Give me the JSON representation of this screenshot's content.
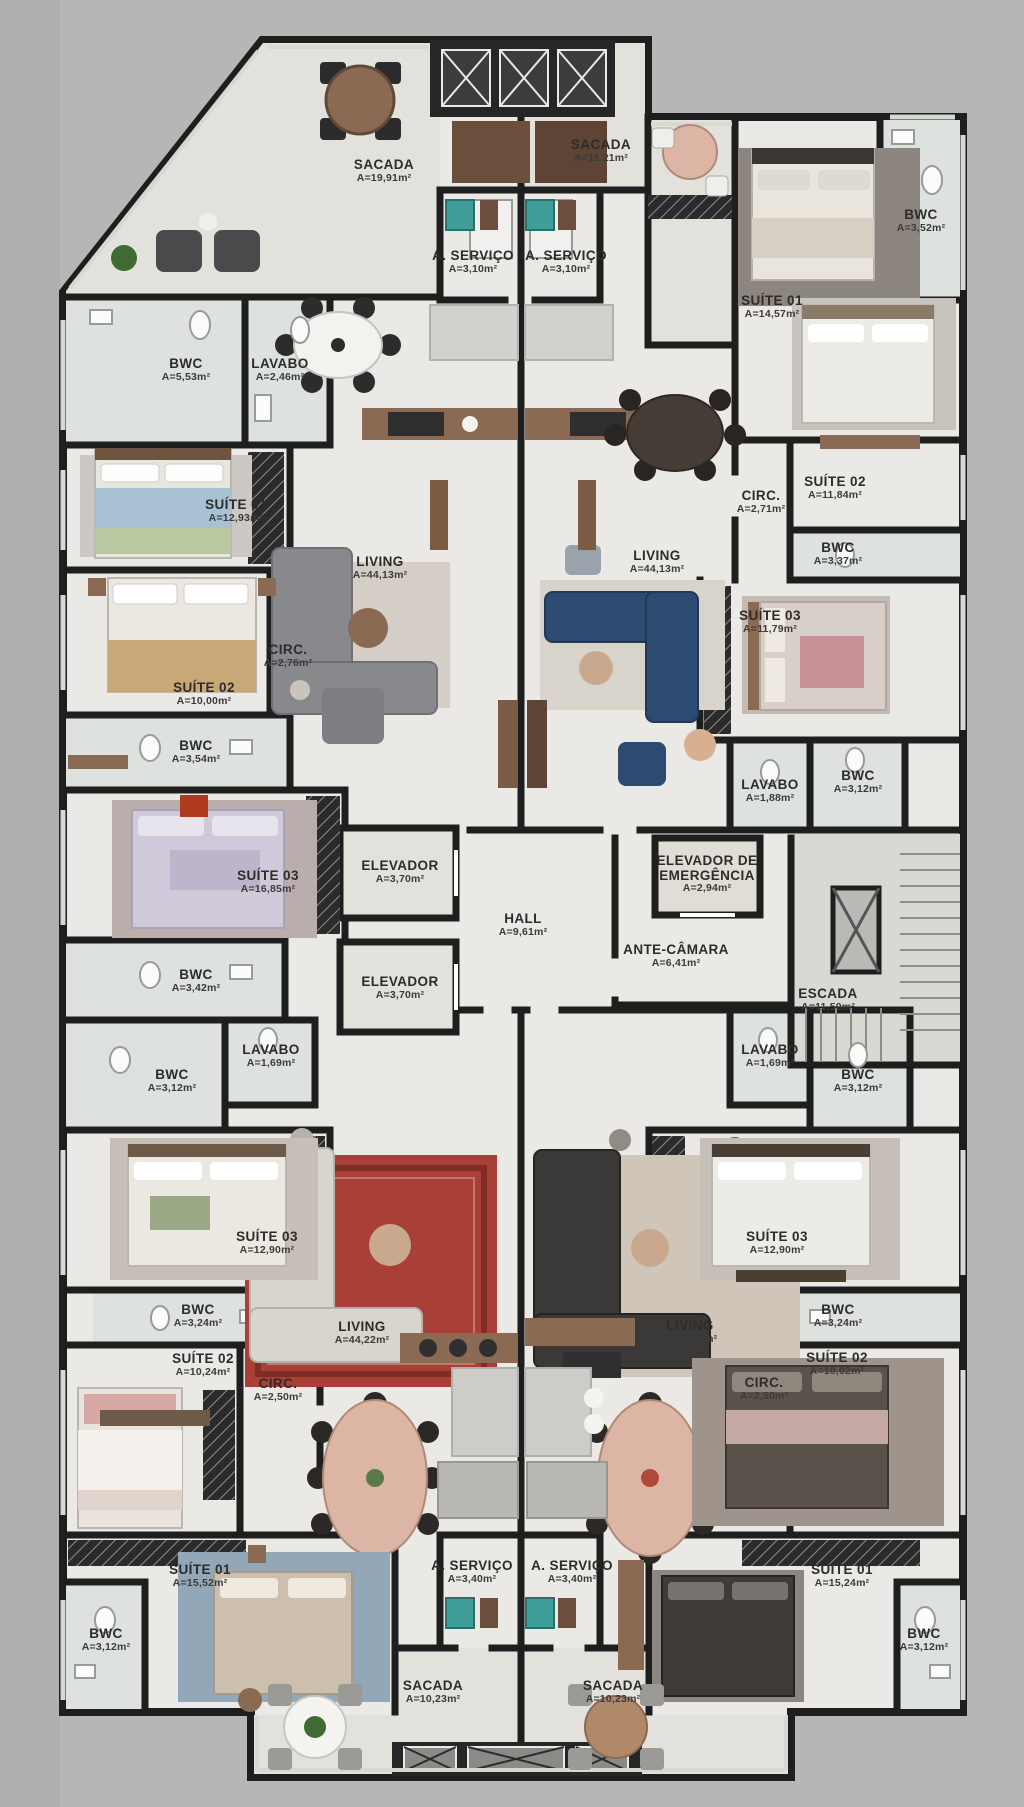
{
  "palette": {
    "exterior": "#b5b7b4",
    "floor": "#eae9e5",
    "balcony_floor": "#e2e1dc",
    "bath_floor": "#dde2df",
    "core_floor": "#d9d8d3",
    "wall": "#1e1e1e",
    "window": "#d6d8d3",
    "wood": "#8a6a52",
    "sofa_blue": "#2d4b70",
    "rug_red": "#a84038",
    "closet": "#2b2b2b"
  },
  "rooms": [
    {
      "id": "sacada-upper-left",
      "name": "SACADA",
      "area": "A=19,91m²",
      "x": 384,
      "y": 171
    },
    {
      "id": "sacada-upper-center",
      "name": "SACADA",
      "area": "A=11,21m²",
      "x": 601,
      "y": 151
    },
    {
      "id": "aservico-upper-left",
      "name": "A. SERVIÇO",
      "area": "A=3,10m²",
      "x": 473,
      "y": 262
    },
    {
      "id": "aservico-upper-right",
      "name": "A. SERVIÇO",
      "area": "A=3,10m²",
      "x": 566,
      "y": 262
    },
    {
      "id": "suite01-upper-right",
      "name": "SUÍTE 01",
      "area": "A=14,57m²",
      "x": 772,
      "y": 307
    },
    {
      "id": "bwc-upper-right",
      "name": "BWC",
      "area": "A=3,52m²",
      "x": 921,
      "y": 221
    },
    {
      "id": "bwc-upper-left",
      "name": "BWC",
      "area": "A=5,53m²",
      "x": 186,
      "y": 370
    },
    {
      "id": "lavabo-upper-left",
      "name": "LAVABO",
      "area": "A=2,46m²",
      "x": 280,
      "y": 370
    },
    {
      "id": "suite01-upper-left",
      "name": "SUÍTE 01",
      "area": "A=12,93m²",
      "x": 236,
      "y": 511
    },
    {
      "id": "suite02-upper-left",
      "name": "SUÍTE 02",
      "area": "A=10,00m²",
      "x": 204,
      "y": 694
    },
    {
      "id": "circ-upper-left",
      "name": "CIRC.",
      "area": "A=2,76m²",
      "x": 288,
      "y": 656
    },
    {
      "id": "living-upper-left",
      "name": "LIVING",
      "area": "A=44,13m²",
      "x": 380,
      "y": 568
    },
    {
      "id": "living-upper-right",
      "name": "LIVING",
      "area": "A=44,13m²",
      "x": 657,
      "y": 562
    },
    {
      "id": "circ-upper-right",
      "name": "CIRC.",
      "area": "A=2,71m²",
      "x": 761,
      "y": 502
    },
    {
      "id": "suite02-upper-right",
      "name": "SUÍTE 02",
      "area": "A=11,84m²",
      "x": 835,
      "y": 488
    },
    {
      "id": "bwc2-upper-right",
      "name": "BWC",
      "area": "A=3,37m²",
      "x": 838,
      "y": 554
    },
    {
      "id": "suite03-upper-right",
      "name": "SUÍTE 03",
      "area": "A=11,79m²",
      "x": 770,
      "y": 622
    },
    {
      "id": "bwc2-upper-left",
      "name": "BWC",
      "area": "A=3,54m²",
      "x": 196,
      "y": 752
    },
    {
      "id": "suite03-upper-left",
      "name": "SUÍTE 03",
      "area": "A=16,85m²",
      "x": 268,
      "y": 882
    },
    {
      "id": "lavabo-upper-right",
      "name": "LAVABO",
      "area": "A=1,88m²",
      "x": 770,
      "y": 791
    },
    {
      "id": "bwc3-upper-right",
      "name": "BWC",
      "area": "A=3,12m²",
      "x": 858,
      "y": 782
    },
    {
      "id": "bwc3-upper-left",
      "name": "BWC",
      "area": "A=3,42m²",
      "x": 196,
      "y": 981
    },
    {
      "id": "elevador-1",
      "name": "ELEVADOR",
      "area": "A=3,70m²",
      "x": 400,
      "y": 872
    },
    {
      "id": "elevador-2",
      "name": "ELEVADOR",
      "area": "A=3,70m²",
      "x": 400,
      "y": 988
    },
    {
      "id": "hall",
      "name": "HALL",
      "area": "A=9,61m²",
      "x": 523,
      "y": 925
    },
    {
      "id": "elevador-emergencia",
      "name": "ELEVADOR DE EMERGÊNCIA",
      "area": "A=2,94m²",
      "x": 707,
      "y": 874
    },
    {
      "id": "ante-camara",
      "name": "ANTE-CÂMARA",
      "area": "A=6,41m²",
      "x": 676,
      "y": 956
    },
    {
      "id": "escada",
      "name": "ESCADA",
      "area": "A=11,50m²",
      "x": 828,
      "y": 1000
    },
    {
      "id": "bwc-lower-left-1",
      "name": "BWC",
      "area": "A=3,12m²",
      "x": 172,
      "y": 1081
    },
    {
      "id": "lavabo-lower-left",
      "name": "LAVABO",
      "area": "A=1,69m²",
      "x": 271,
      "y": 1056
    },
    {
      "id": "lavabo-lower-right",
      "name": "LAVABO",
      "area": "A=1,69m²",
      "x": 770,
      "y": 1056
    },
    {
      "id": "bwc-lower-right-1",
      "name": "BWC",
      "area": "A=3,12m²",
      "x": 858,
      "y": 1081
    },
    {
      "id": "suite03-lower-left",
      "name": "SUÍTE 03",
      "area": "A=12,90m²",
      "x": 267,
      "y": 1243
    },
    {
      "id": "suite03-lower-right",
      "name": "SUÍTE 03",
      "area": "A=12,90m²",
      "x": 777,
      "y": 1243
    },
    {
      "id": "bwc2-lower-left",
      "name": "BWC",
      "area": "A=3,24m²",
      "x": 198,
      "y": 1316
    },
    {
      "id": "bwc2-lower-right",
      "name": "BWC",
      "area": "A=3,24m²",
      "x": 838,
      "y": 1316
    },
    {
      "id": "suite02-lower-left",
      "name": "SUÍTE 02",
      "area": "A=10,24m²",
      "x": 203,
      "y": 1365
    },
    {
      "id": "suite02-lower-right",
      "name": "SUÍTE 02",
      "area": "A=10,02m²",
      "x": 837,
      "y": 1364
    },
    {
      "id": "circ-lower-left",
      "name": "CIRC.",
      "area": "A=2,50m²",
      "x": 278,
      "y": 1390
    },
    {
      "id": "circ-lower-right",
      "name": "CIRC.",
      "area": "A=2,50m²",
      "x": 764,
      "y": 1389
    },
    {
      "id": "living-lower-left",
      "name": "LIVING",
      "area": "A=44,22m²",
      "x": 362,
      "y": 1333
    },
    {
      "id": "living-lower-right",
      "name": "LIVING",
      "area": "A=44,22m²",
      "x": 690,
      "y": 1332
    },
    {
      "id": "suite01-lower-left",
      "name": "SUÍTE 01",
      "area": "A=15,52m²",
      "x": 200,
      "y": 1576
    },
    {
      "id": "suite01-lower-right",
      "name": "SUÍTE 01",
      "area": "A=15,24m²",
      "x": 842,
      "y": 1576
    },
    {
      "id": "bwc-bottom-left",
      "name": "BWC",
      "area": "A=3,12m²",
      "x": 106,
      "y": 1640
    },
    {
      "id": "bwc-bottom-right",
      "name": "BWC",
      "area": "A=3,12m²",
      "x": 924,
      "y": 1640
    },
    {
      "id": "aservico-lower-left",
      "name": "A. SERVIÇO",
      "area": "A=3,40m²",
      "x": 472,
      "y": 1572
    },
    {
      "id": "aservico-lower-right",
      "name": "A. SERVIÇO",
      "area": "A=3,40m²",
      "x": 572,
      "y": 1572
    },
    {
      "id": "sacada-lower-left",
      "name": "SACADA",
      "area": "A=10,23m²",
      "x": 433,
      "y": 1692
    },
    {
      "id": "sacada-lower-right",
      "name": "SACADA",
      "area": "A=10,23m²",
      "x": 613,
      "y": 1692
    }
  ]
}
